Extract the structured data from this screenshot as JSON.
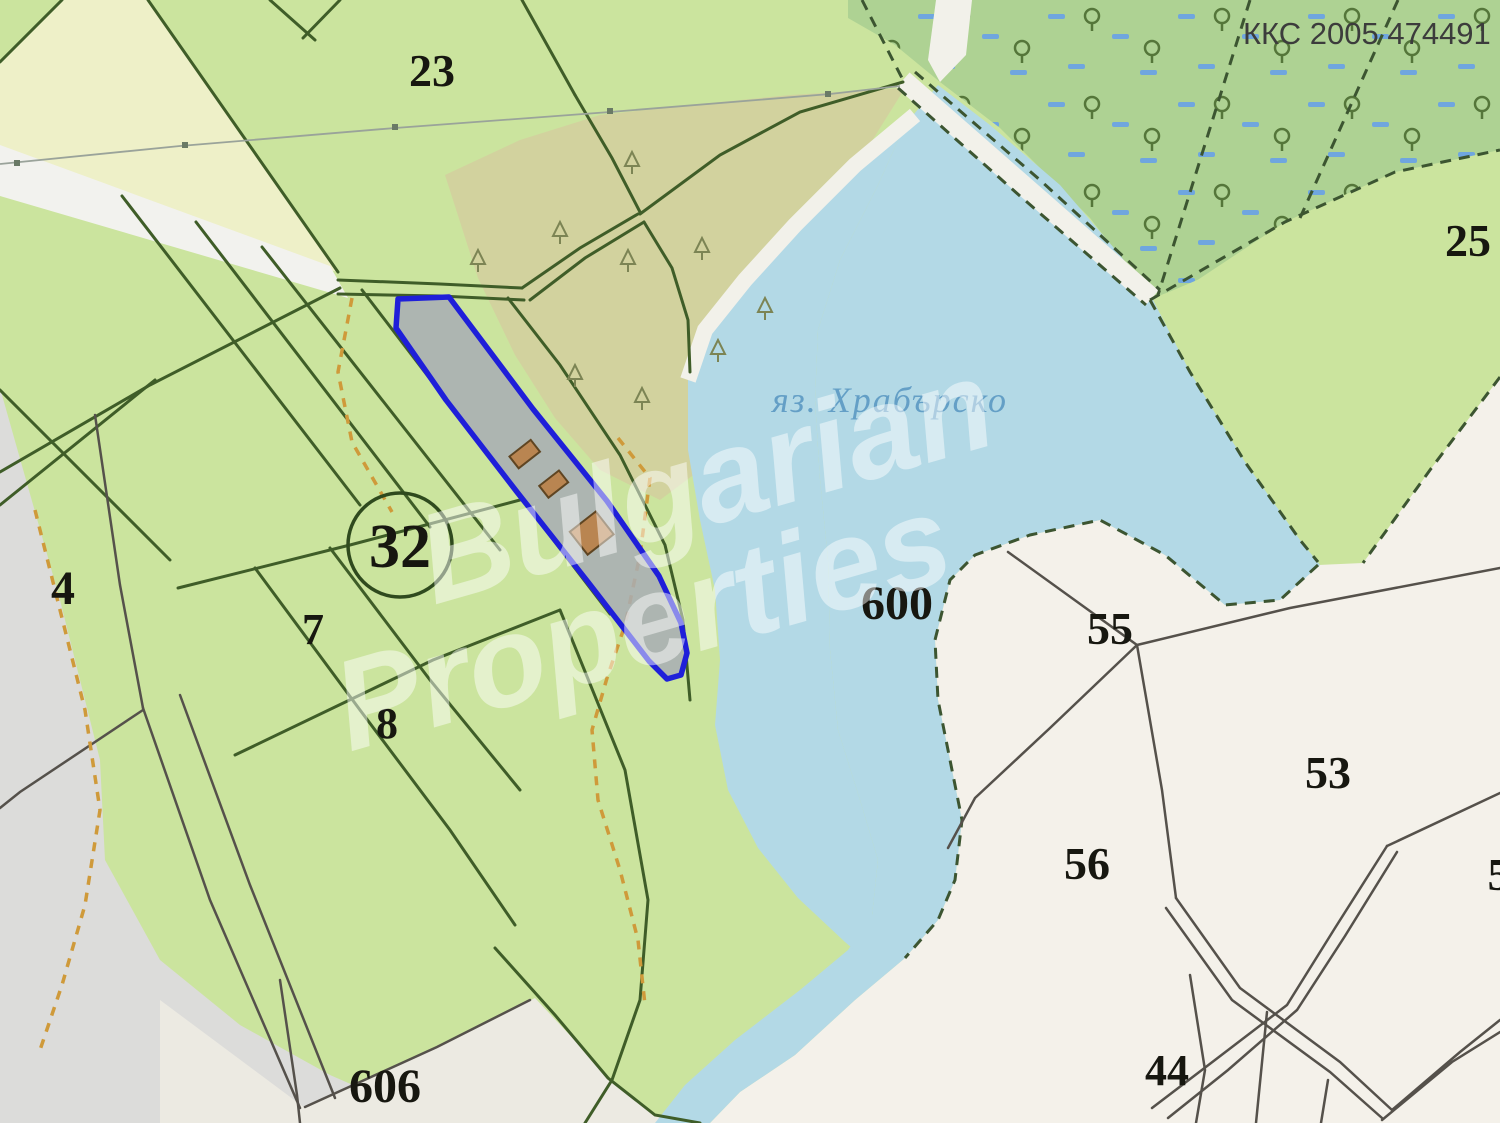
{
  "map": {
    "corner_code": "ККС 2005 474491",
    "water_label": {
      "text": "яз. Храбърско"
    },
    "watermark": {
      "line1": "Bulgarian",
      "line2": "Properties"
    },
    "labels": [
      {
        "text": "23"
      },
      {
        "text": "25"
      },
      {
        "text": "32"
      },
      {
        "text": "4"
      },
      {
        "text": "7"
      },
      {
        "text": "8"
      },
      {
        "text": "606"
      },
      {
        "text": "600"
      },
      {
        "text": "55"
      },
      {
        "text": "53"
      },
      {
        "text": "56"
      },
      {
        "text": "44"
      },
      {
        "text": "5"
      }
    ],
    "highlighted_parcel": {
      "outline_color": "#1f1fd9",
      "fill_color": "rgba(168,173,180,0.85)",
      "buildings": 3,
      "building_color": "#b98551"
    },
    "colors": {
      "field_green": "#cbe49e",
      "pale_field": "#eef0c8",
      "scrub_olive": "#d2d29e",
      "marsh_green": "#aed293",
      "marsh_dash_blue": "#6fa6df",
      "lake_blue": "#b3d9e6",
      "white_parcel": "#f4f1ea",
      "gray_zone": "#dcdcda",
      "boundary_green": "#3f5d28",
      "boundary_gray": "#55514b",
      "path_orange": "#cf9a3a"
    }
  }
}
